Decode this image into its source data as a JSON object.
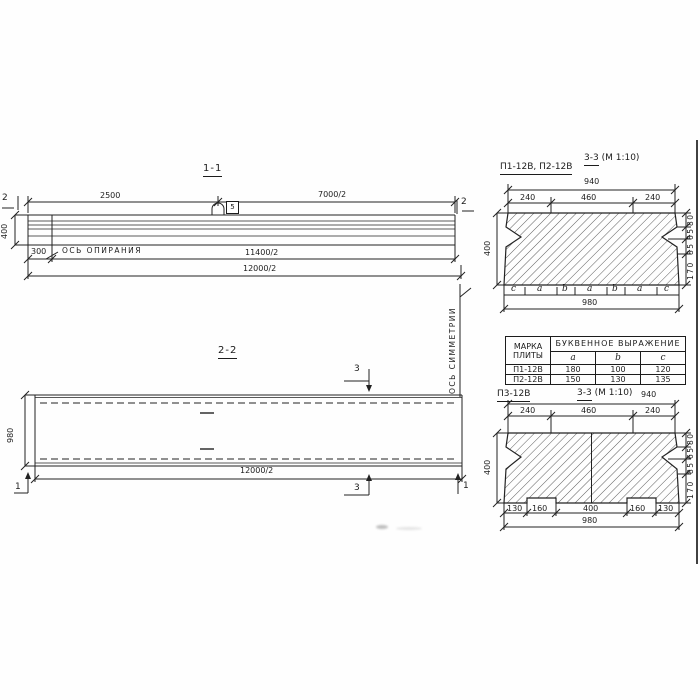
{
  "sheet": {
    "s11": {
      "title": "1-1",
      "d2500": "2500",
      "d7000": "7000/2",
      "d300": "300",
      "d11400": "11400/2",
      "d12000": "12000/2",
      "h400": "400",
      "cut_left": "2",
      "cut_right": "2",
      "axis": "ОСЬ ОПИРАНИЯ",
      "loop_detail": "5"
    },
    "s33t": {
      "plates": "П1-12В, П2-12В",
      "title": "3-3",
      "scale": "(М 1:10)",
      "w940": "940",
      "wl240": "240",
      "w460": "460",
      "wr240": "240",
      "h400": "400",
      "r80": "80",
      "r65": "65",
      "r85": "85",
      "r170": "170",
      "w980": "980",
      "letters": [
        "c",
        "a",
        "b",
        "a",
        "b",
        "a",
        "c"
      ]
    },
    "tbl": {
      "mark_header": "МАРКА ПЛИТЫ",
      "expr_header": "БУКВЕННОЕ ВЫРАЖЕНИЕ",
      "cols": [
        "a",
        "b",
        "c"
      ],
      "rows": [
        {
          "mark": "П1-12В",
          "a": "180",
          "b": "100",
          "c": "120"
        },
        {
          "mark": "П2-12В",
          "a": "150",
          "b": "130",
          "c": "135"
        }
      ]
    },
    "s33b": {
      "plates": "П3-12В",
      "title": "3-3",
      "scale": "(М 1:10)",
      "w940": "940",
      "wl240": "240",
      "w460": "460",
      "wr240": "240",
      "h400": "400",
      "r80": "80",
      "r65": "65",
      "r85": "85",
      "r170": "170",
      "b130l": "130",
      "b160l": "160",
      "b400": "400",
      "b160r": "160",
      "b130r": "130",
      "w980": "980"
    },
    "s22": {
      "title": "2-2",
      "h980": "980",
      "d12000": "12000/2",
      "cut3_top": "3",
      "cut3_bottom": "3",
      "cut1_left": "1",
      "cut1_right": "1",
      "axis": "ОСЬ СИММЕТРИИ"
    }
  }
}
